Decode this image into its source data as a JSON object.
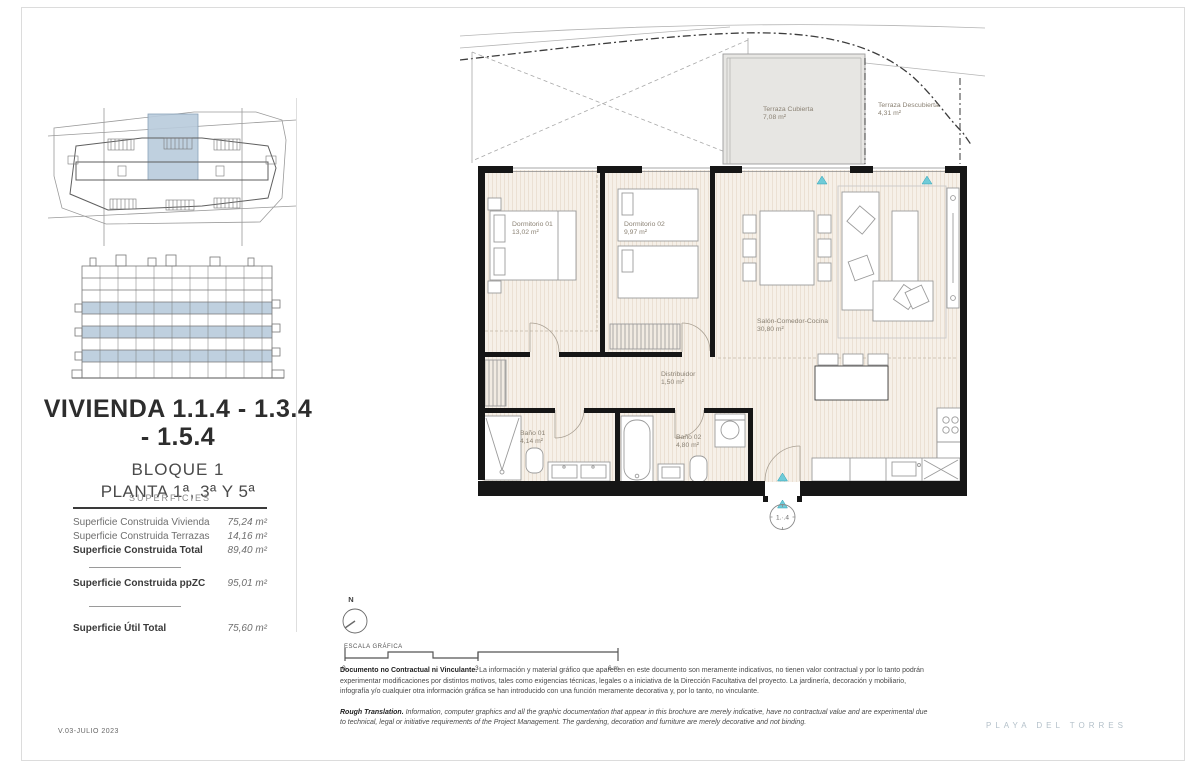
{
  "left_panel": {
    "title": "VIVIENDA 1.1.4 - 1.3.4 - 1.5.4",
    "block": "BLOQUE 1",
    "floor": "PLANTA 1ª, 3ª Y 5ª",
    "superficies": {
      "header": "SUPERFICIES",
      "rows": [
        {
          "label": "Superficie Construida Vivienda",
          "value": "75,24 m²"
        },
        {
          "label": "Superficie Construida Terrazas",
          "value": "14,16 m²"
        },
        {
          "label": "Superficie Construida Total",
          "value": "89,40 m²"
        },
        {
          "label": "Superficie Construida ppZC",
          "value": "95,01 m²"
        },
        {
          "label": "Superficie Útil Total",
          "value": "75,60 m²"
        }
      ]
    }
  },
  "floor_plan": {
    "rooms": [
      {
        "name": "Terraza Cubierta",
        "area": "7,08 m²"
      },
      {
        "name": "Terraza Descubierta",
        "area": "4,31 m²"
      },
      {
        "name": "Dormitorio 01",
        "area": "13,02 m²"
      },
      {
        "name": "Dormitorio 02",
        "area": "9,97 m²"
      },
      {
        "name": "Salón-Comedor-Cocina",
        "area": "30,80 m²"
      },
      {
        "name": "Distribuidor",
        "area": "1,50 m²"
      },
      {
        "name": "Baño 01",
        "area": "4,14 m²"
      },
      {
        "name": "Baño 02",
        "area": "4,80 m²"
      }
    ],
    "unit_marker": "1.·.4",
    "compass_north": "N"
  },
  "scale_bar": {
    "label": "ESCALA GRÁFICA",
    "ticks": [
      "0",
      "3",
      "6 m"
    ]
  },
  "disclaimer": {
    "es_lead": "Documento no Contractual ni Vinculante.",
    "es_text": " La información y material gráfico que aparecen en este documento son meramente indicativos, no tienen valor contractual y por lo tanto podrán experimentar modificaciones por distintos motivos, tales como exigencias técnicas, legales o a iniciativa de la Dirección Facultativa del proyecto. La jardinería, decoración y mobiliario, infografía y/o cualquier otra información gráfica se han introducido con una función meramente decorativa y, por lo tanto, no vinculante.",
    "en_lead": "Rough Translation.",
    "en_text": " Information, computer graphics and all the graphic documentation that appear in this brochure are merely indicative, have no contractual value and are experimental due to technical, legal or initiative requirements of the Project Management. The gardening, decoration and furniture are merely decorative and not binding."
  },
  "footer": {
    "version": "V.03-JULIO 2023",
    "brand": "PLAYA DEL TORRES"
  },
  "colors": {
    "accent_teal": "#58c3d2",
    "highlight_blue": "#b9cbdc",
    "wall_black": "#161616",
    "floor_cream": "#f6f0e8",
    "terrace_gray": "#e7e6e3",
    "brand_gray": "#b4c1ca"
  }
}
